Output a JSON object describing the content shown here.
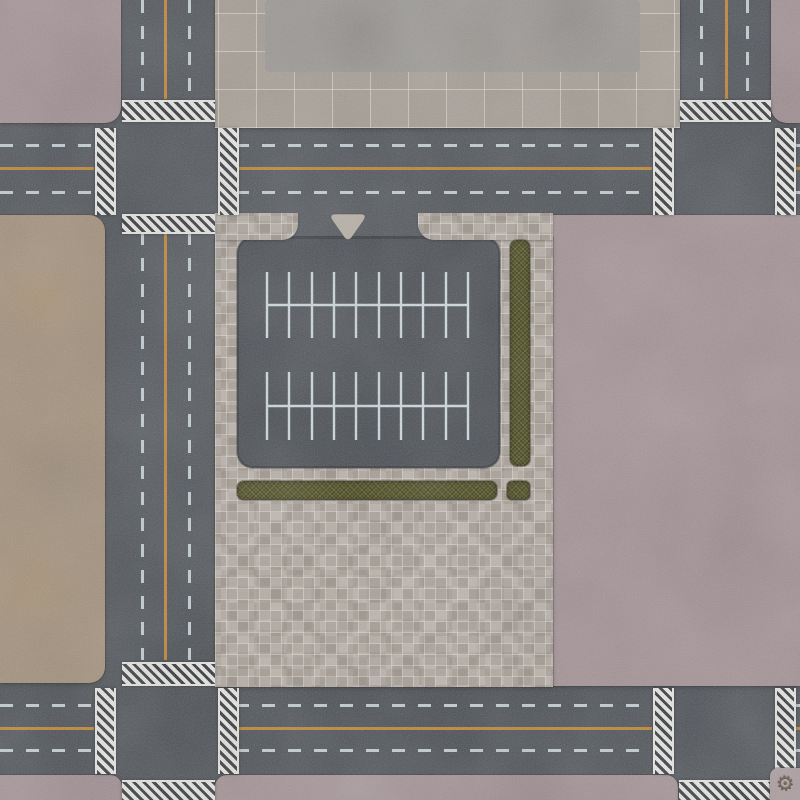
{
  "palette": {
    "asphalt": "#4c5157",
    "asphalt-lot": "#454a50",
    "pink": "#a39194",
    "pink-light": "#ab9b9e",
    "tan": "#a28f79",
    "tile": "#a79f96",
    "patch": "#9a9794",
    "mosaic": "#b2a99f",
    "hedge": "#4d4e1f",
    "dash": "#cdd9dd",
    "orange": "#c5862c",
    "cw-white": "#e9e8e4",
    "cw-dark": "#2f343a",
    "island": "#b6afa6",
    "ink": "#4a3a28"
  },
  "markings": {
    "dash_length_px": 13,
    "dash_gap_px": 13,
    "center_line_style": "solid-orange",
    "edge_line_style": "dashed-white"
  },
  "parking": {
    "line_xs": [
      30,
      52,
      75,
      97,
      119,
      142,
      164,
      186,
      209,
      231
    ],
    "rows": [
      {
        "spine_y": 68,
        "line_top": 35,
        "line_bottom": 101
      },
      {
        "spine_y": 169,
        "line_top": 135,
        "line_bottom": 203
      }
    ],
    "stroke_color": "#cfdbdf",
    "stroke_width": 2.4,
    "spaces_per_row": 18
  },
  "logo": {
    "glyph": "⚙"
  }
}
